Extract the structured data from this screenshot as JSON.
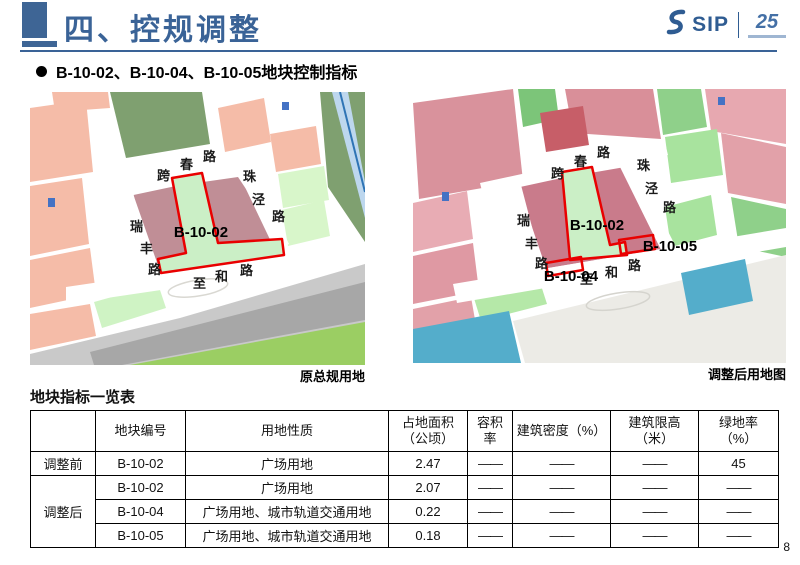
{
  "header": {
    "title": "四、控规调整",
    "logo": {
      "sip": "SIP",
      "anniversary": "25"
    }
  },
  "bullet": "B-10-02、B-10-04、B-10-05地块控制指标",
  "maps": {
    "roads": {
      "kuachun": [
        "跨",
        "春",
        "路"
      ],
      "zhujing": [
        "珠",
        "泾",
        "路"
      ],
      "ruifeng": [
        "瑞",
        "丰",
        "路"
      ],
      "zhihe": [
        "至",
        "和",
        "路"
      ]
    },
    "left": {
      "caption": "原总规用地",
      "block": "B-10-02"
    },
    "right": {
      "caption": "调整后用地图",
      "b1002": "B-10-02",
      "b1004": "B-10-04",
      "b1005": "B-10-05"
    }
  },
  "table": {
    "title": "地块指标一览表",
    "headers": {
      "code": "地块编号",
      "use": "用地性质",
      "area": "占地面积\n（公顷）",
      "far": "容积\n率",
      "density": "建筑密度（%）",
      "height": "建筑限高\n（米）",
      "green": "绿地率\n（%）"
    },
    "groups": {
      "before": "调整前",
      "after": "调整后"
    },
    "rows": [
      {
        "code": "B-10-02",
        "use": "广场用地",
        "area": "2.47",
        "far": "——",
        "density": "——",
        "height": "——",
        "green": "45"
      },
      {
        "code": "B-10-02",
        "use": "广场用地",
        "area": "2.07",
        "far": "——",
        "density": "——",
        "height": "——",
        "green": "——"
      },
      {
        "code": "B-10-04",
        "use": "广场用地、城市轨道交通用地",
        "area": "0.22",
        "far": "——",
        "density": "——",
        "height": "——",
        "green": "——"
      },
      {
        "code": "B-10-05",
        "use": "广场用地、城市轨道交通用地",
        "area": "0.18",
        "far": "——",
        "density": "——",
        "height": "——",
        "green": "——"
      }
    ]
  },
  "page_number": "8",
  "colors": {
    "accent_blue": "#3A6397",
    "value_red": "#C00000",
    "outline_red": "#E90000"
  }
}
